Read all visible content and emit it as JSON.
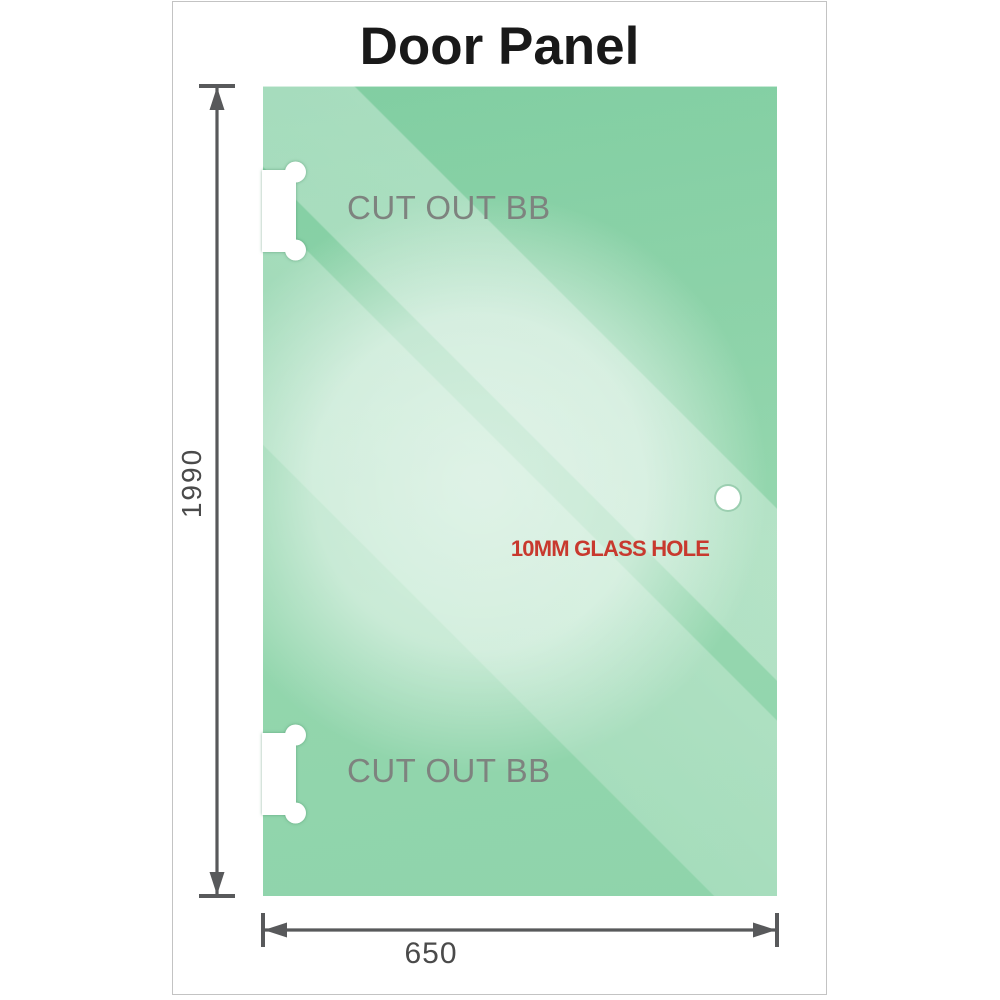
{
  "title": "Door Panel",
  "panel": {
    "cutout_top_label": "CUT OUT BB",
    "cutout_bottom_label": "CUT OUT BB",
    "glass_hole_label": "10MM GLASS HOLE"
  },
  "dimensions": {
    "height_value": "1990",
    "width_value": "650"
  },
  "icons": {
    "height_dimension_arrow": "double-headed-vertical-arrow",
    "width_dimension_arrow": "double-headed-horizontal-arrow",
    "hinge_cutout": "white-notch-with-round-lobes",
    "glass_hole": "white-circle"
  },
  "colors": {
    "glass_green_top": "#7fcda0",
    "glass_green_bottom": "#8fd4ab",
    "glass_sheen_light": "#d8f0e0",
    "hole_label_red": "#c8392e",
    "cutout_label_gray": "#7e837f",
    "dimension_gray": "#58595b",
    "title_black": "#191919",
    "frame_border": "#c3c3c3",
    "background": "#ffffff"
  }
}
